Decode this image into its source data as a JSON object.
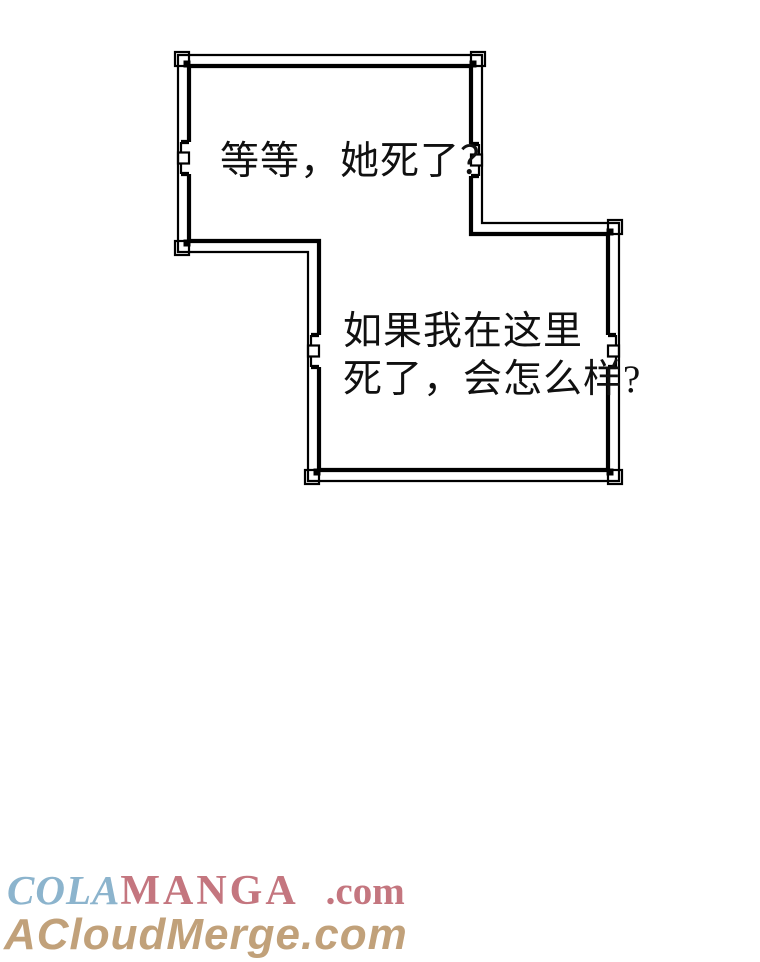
{
  "page": {
    "background": "#ffffff",
    "frame_color": "#000000",
    "text_color": "#101010"
  },
  "bubbles": {
    "bubble1": {
      "text": "等等，她死了？"
    },
    "bubble2": {
      "line1": "如果我在这里",
      "line2": "死了，会怎么样?"
    }
  },
  "watermarks": {
    "site1": {
      "cola": "COLA",
      "manga": "MANGA",
      "dotcom": ".com",
      "cola_color": "#8cb4cd",
      "manga_color": "#c4767f"
    },
    "site2": {
      "text": "ACloudMerge.com",
      "color": "#c1a17a"
    }
  }
}
